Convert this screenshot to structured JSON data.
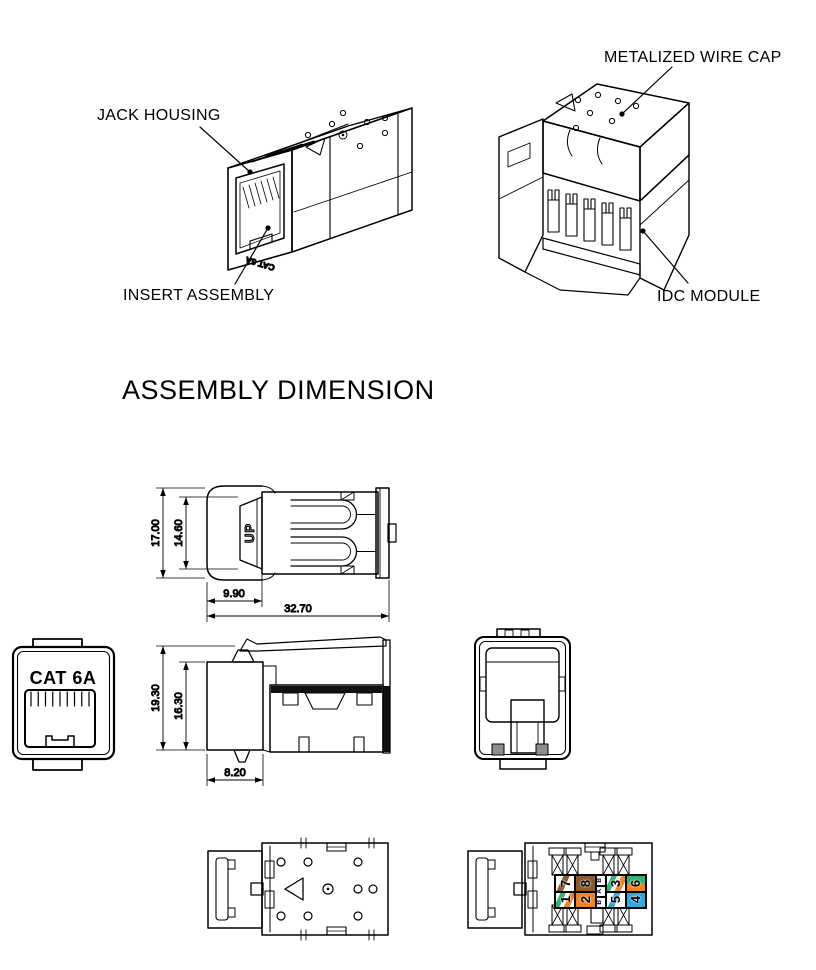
{
  "page": {
    "background": "#ffffff",
    "line_color": "#000000"
  },
  "callouts": {
    "jack_housing": "JACK HOUSING",
    "insert_assembly": "INSERT ASSEMBLY",
    "metalized_wire_cap": "METALIZED WIRE CAP",
    "idc_module": "IDC MODULE"
  },
  "section": {
    "title": "ASSEMBLY DIMENSION"
  },
  "markings": {
    "front_label": "CAT 6A",
    "iso_front_label": "CAT 6A",
    "up_label": "UP"
  },
  "dimensions": {
    "top_view": {
      "overall_width": "17.00",
      "inner_width": "14.60",
      "front_depth": "9.90",
      "overall_length": "32.70"
    },
    "side_view": {
      "overall_height": "19.30",
      "inner_height": "16.30",
      "front_depth": "8.20"
    }
  },
  "wiring_label": {
    "standard_letters": [
      "B",
      "A",
      "B"
    ],
    "colors": {
      "orange": "#F5821F",
      "green": "#2BB673",
      "blue": "#29ABE2",
      "brown": "#8C5A2B",
      "white": "#FFFFFF"
    },
    "columns": [
      {
        "type": "cells",
        "cells": [
          {
            "number": "7",
            "pattern": "stripe",
            "colors": [
              "brown"
            ]
          },
          {
            "number": "1",
            "pattern": "stripe2",
            "colors": [
              "green",
              "orange"
            ]
          }
        ]
      },
      {
        "type": "cells",
        "cells": [
          {
            "number": "8",
            "pattern": "solid",
            "colors": [
              "brown"
            ]
          },
          {
            "number": "2",
            "pattern": "solid",
            "colors": [
              "orange"
            ]
          }
        ]
      },
      {
        "type": "letters"
      },
      {
        "type": "cells",
        "cells": [
          {
            "number": "3",
            "pattern": "stripe2",
            "colors": [
              "green",
              "orange"
            ]
          },
          {
            "number": "5",
            "pattern": "stripe",
            "colors": [
              "blue"
            ]
          }
        ]
      },
      {
        "type": "cells",
        "cells": [
          {
            "number": "6",
            "pattern": "split",
            "colors": [
              "green",
              "orange"
            ]
          },
          {
            "number": "4",
            "pattern": "solid",
            "colors": [
              "blue"
            ]
          }
        ]
      }
    ]
  }
}
